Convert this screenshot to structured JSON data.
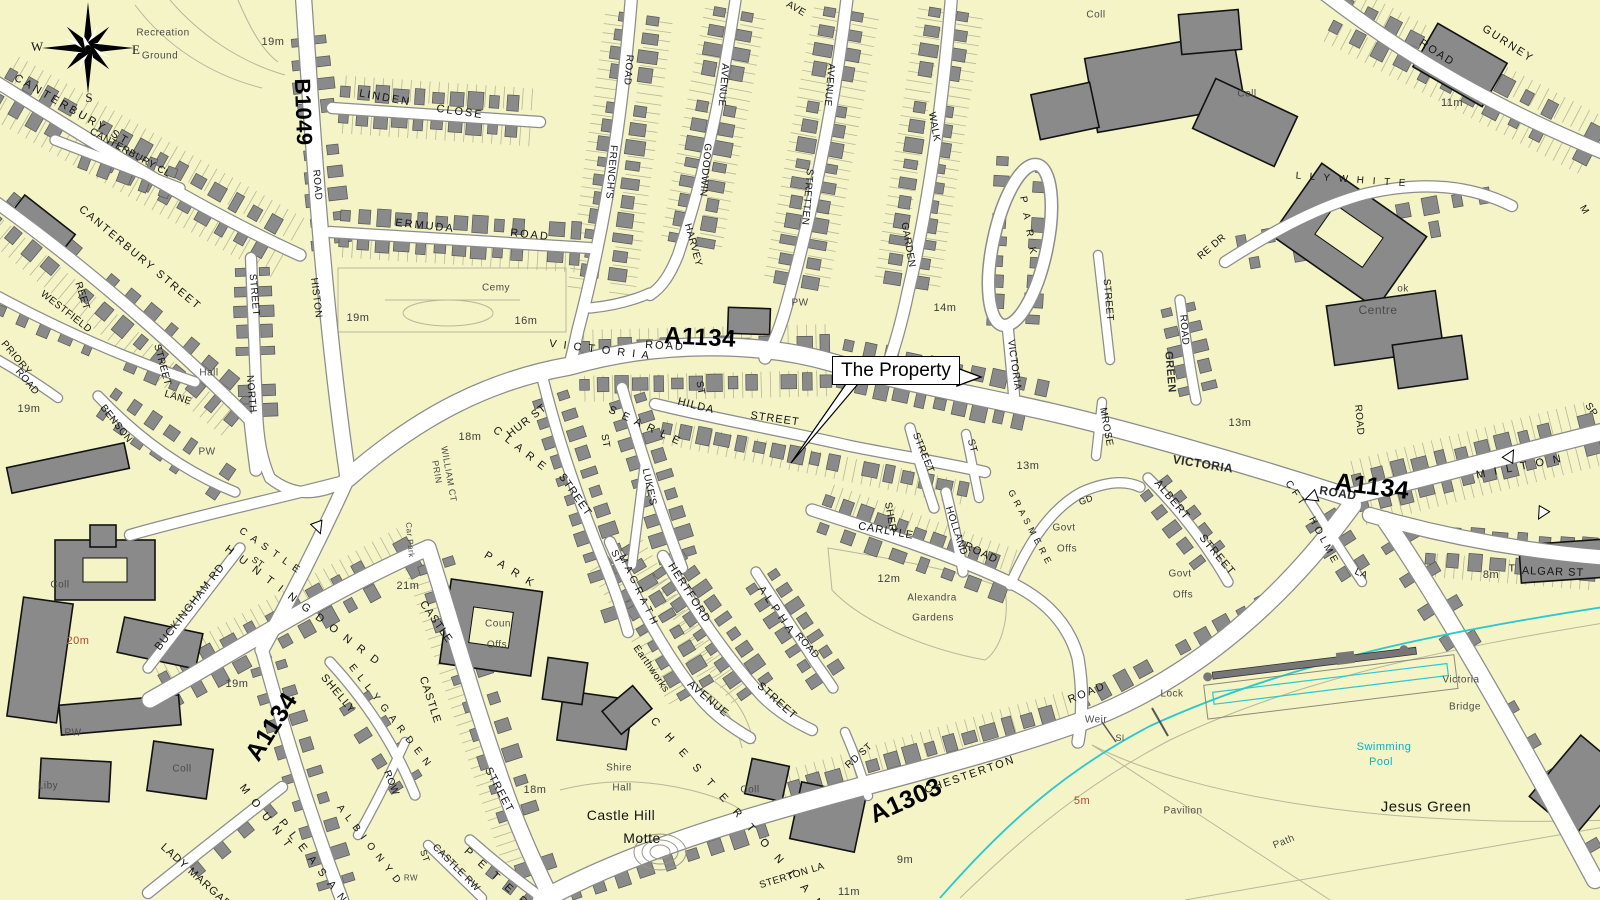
{
  "map": {
    "callout": {
      "text": "The Property"
    },
    "compass": {
      "west": "W",
      "east": "E",
      "south": "S"
    },
    "colors": {
      "land": "#f4f4c6",
      "building": "#8a8a8a",
      "building_outline": "#565656",
      "public_building_outline": "#111111",
      "road_fill": "#ffffff",
      "road_casing": "#8c8c8c",
      "parcel_line": "#b7b79b",
      "water": "#2cc8d0",
      "street_label": "#141414",
      "minor_label": "#4a4a4a",
      "spot_height_red": "#b5472e",
      "route_label": "#000000"
    },
    "labels": [
      {
        "t": "Recreation",
        "x": 163,
        "y": 33,
        "c": "minor"
      },
      {
        "t": "Ground",
        "x": 160,
        "y": 56,
        "c": "minor"
      },
      {
        "t": "19m",
        "x": 273,
        "y": 42,
        "c": "spot"
      },
      {
        "t": "CANTERBURY ST",
        "x": 72,
        "y": 110,
        "r": 30,
        "ls": 3
      },
      {
        "t": "CANTERBURY CL",
        "x": 130,
        "y": 153,
        "r": 29,
        "s": 10
      },
      {
        "t": "CANTERBURY STREET",
        "x": 140,
        "y": 258,
        "r": 40,
        "ls": 2
      },
      {
        "t": "WESTFIELD",
        "x": 66,
        "y": 312,
        "r": 38,
        "s": 10
      },
      {
        "t": "REET",
        "x": 82,
        "y": 296,
        "r": 72,
        "s": 10
      },
      {
        "t": "PRIORY",
        "x": 16,
        "y": 358,
        "r": 50,
        "s": 10
      },
      {
        "t": "ROAD",
        "x": 27,
        "y": 382,
        "r": 50,
        "s": 10
      },
      {
        "t": "19m",
        "x": 29,
        "y": 409,
        "c": "spot"
      },
      {
        "t": "BENSON",
        "x": 116,
        "y": 424,
        "r": 52,
        "s": 10
      },
      {
        "t": "STREET",
        "x": 162,
        "y": 365,
        "r": 75,
        "s": 10
      },
      {
        "t": "LANE",
        "x": 178,
        "y": 398,
        "r": 18,
        "s": 10
      },
      {
        "t": "Hall",
        "x": 209,
        "y": 373,
        "c": "minor"
      },
      {
        "t": "PW",
        "x": 207,
        "y": 452,
        "c": "minor"
      },
      {
        "t": "STREET",
        "x": 254,
        "y": 295,
        "r": 85,
        "s": 10
      },
      {
        "t": "NORTH",
        "x": 251,
        "y": 394,
        "r": 85,
        "s": 10
      },
      {
        "t": "B1049",
        "x": 303,
        "y": 112,
        "r": 88,
        "c": "route",
        "s": 22
      },
      {
        "t": "ROAD",
        "x": 317,
        "y": 185,
        "r": 85,
        "s": 10
      },
      {
        "t": "HISTON",
        "x": 316,
        "y": 298,
        "r": 83,
        "s": 10
      },
      {
        "t": "LINDEN",
        "x": 385,
        "y": 98,
        "r": 10,
        "ls": 2
      },
      {
        "t": "CLOSE",
        "x": 460,
        "y": 112,
        "r": 8,
        "ls": 2
      },
      {
        "t": "ERMUDA",
        "x": 425,
        "y": 226,
        "r": 6,
        "ls": 2
      },
      {
        "t": "ROAD",
        "x": 530,
        "y": 235,
        "r": 6,
        "ls": 2
      },
      {
        "t": "Cemy",
        "x": 496,
        "y": 288,
        "c": "minor"
      },
      {
        "t": "19m",
        "x": 358,
        "y": 318,
        "c": "spot"
      },
      {
        "t": "16m",
        "x": 526,
        "y": 321,
        "c": "spot"
      },
      {
        "t": "ROAD",
        "x": 628,
        "y": 70,
        "r": 95,
        "s": 10
      },
      {
        "t": "FRENCH'S",
        "x": 611,
        "y": 172,
        "r": 95,
        "s": 10
      },
      {
        "t": "AVENUE",
        "x": 723,
        "y": 85,
        "r": 95,
        "s": 10
      },
      {
        "t": "GOODWIN",
        "x": 705,
        "y": 170,
        "r": 95,
        "s": 10
      },
      {
        "t": "HARVEY",
        "x": 693,
        "y": 245,
        "r": 75,
        "s": 10
      },
      {
        "t": "AVE",
        "x": 796,
        "y": 9,
        "r": 30,
        "s": 10
      },
      {
        "t": "AVENUE",
        "x": 829,
        "y": 85,
        "r": 95,
        "s": 10
      },
      {
        "t": "STRETTEN",
        "x": 807,
        "y": 197,
        "r": 95,
        "s": 10
      },
      {
        "t": "WALK",
        "x": 934,
        "y": 127,
        "r": 80,
        "s": 10
      },
      {
        "t": "GARDEN",
        "x": 908,
        "y": 245,
        "r": 80,
        "s": 10
      },
      {
        "t": "PW",
        "x": 800,
        "y": 303,
        "c": "minor"
      },
      {
        "t": "14m",
        "x": 945,
        "y": 308,
        "c": "spot"
      },
      {
        "t": "P A R K",
        "x": 1028,
        "y": 227,
        "r": 80,
        "s": 10,
        "ls": 4
      },
      {
        "t": "VICTORIA",
        "x": 1014,
        "y": 365,
        "r": 82,
        "s": 10
      },
      {
        "t": "STREET",
        "x": 1108,
        "y": 300,
        "r": 85,
        "s": 10
      },
      {
        "t": "Coll",
        "x": 1096,
        "y": 15,
        "c": "minor"
      },
      {
        "t": "Coll",
        "x": 1247,
        "y": 94,
        "c": "minor"
      },
      {
        "t": "ROAD",
        "x": 1437,
        "y": 53,
        "r": 33,
        "ls": 2
      },
      {
        "t": "GURNEY",
        "x": 1508,
        "y": 44,
        "r": 33,
        "ls": 2
      },
      {
        "t": "11m",
        "x": 1452,
        "y": 103,
        "c": "spot"
      },
      {
        "t": "L L Y W H I T E",
        "x": 1352,
        "y": 180,
        "r": 4,
        "s": 10,
        "ls": 3
      },
      {
        "t": "RE DR",
        "x": 1212,
        "y": 247,
        "r": -40,
        "s": 10
      },
      {
        "t": "M",
        "x": 1584,
        "y": 210,
        "r": 60,
        "s": 10
      },
      {
        "t": "ok",
        "x": 1403,
        "y": 289,
        "c": "minor"
      },
      {
        "t": "Centre",
        "x": 1378,
        "y": 310,
        "c": "minor",
        "s": 12
      },
      {
        "t": "GREEN",
        "x": 1170,
        "y": 372,
        "r": 85,
        "c": "routeGrey",
        "s": 11
      },
      {
        "t": "ROAD",
        "x": 1184,
        "y": 330,
        "r": 85,
        "s": 10
      },
      {
        "t": "13m",
        "x": 1240,
        "y": 423,
        "c": "spot"
      },
      {
        "t": "MROSE",
        "x": 1106,
        "y": 427,
        "r": 80,
        "s": 10
      },
      {
        "t": "VICTORIA",
        "x": 1203,
        "y": 464,
        "r": 9,
        "c": "routeGrey",
        "s": 12
      },
      {
        "t": "ROAD",
        "x": 1338,
        "y": 493,
        "r": 9,
        "c": "routeGrey",
        "s": 12
      },
      {
        "t": "A1134",
        "x": 1372,
        "y": 487,
        "r": 7,
        "c": "route",
        "s": 25
      },
      {
        "t": "ROAD",
        "x": 1359,
        "y": 420,
        "r": 85,
        "s": 10
      },
      {
        "t": "M I L T O N",
        "x": 1520,
        "y": 467,
        "r": -11,
        "ls": 3
      },
      {
        "t": "SP",
        "x": 1591,
        "y": 410,
        "r": 55,
        "s": 10
      },
      {
        "t": "C F T",
        "x": 1295,
        "y": 493,
        "r": 55,
        "s": 10
      },
      {
        "t": "H O L M E",
        "x": 1323,
        "y": 540,
        "r": 62,
        "s": 10
      },
      {
        "t": "LA",
        "x": 1361,
        "y": 574,
        "r": 25,
        "s": 10
      },
      {
        "t": "8m",
        "x": 1491,
        "y": 575,
        "c": "spot"
      },
      {
        "t": "T",
        "x": 1512,
        "y": 569,
        "s": 10
      },
      {
        "t": "ALGAR ST",
        "x": 1553,
        "y": 572,
        "r": 2,
        "ls": 1
      },
      {
        "t": "A1134",
        "x": 700,
        "y": 338,
        "r": 3,
        "c": "route",
        "s": 24
      },
      {
        "t": "V I C T O R I A",
        "x": 600,
        "y": 350,
        "r": 7,
        "ls": 2
      },
      {
        "t": "ROAD",
        "x": 665,
        "y": 346,
        "r": 3,
        "ls": 2
      },
      {
        "t": "ST",
        "x": 700,
        "y": 388,
        "r": 80,
        "s": 10
      },
      {
        "t": "HILDA",
        "x": 696,
        "y": 406,
        "r": 14,
        "ls": 1
      },
      {
        "t": "STREET",
        "x": 775,
        "y": 419,
        "r": 8,
        "ls": 1
      },
      {
        "t": "18m",
        "x": 470,
        "y": 437,
        "c": "spot"
      },
      {
        "t": "PRIN",
        "x": 437,
        "y": 472,
        "r": 80,
        "s": 9,
        "c": "minor"
      },
      {
        "t": "WILLIAM CT",
        "x": 449,
        "y": 474,
        "r": 80,
        "s": 9,
        "c": "minor"
      },
      {
        "t": "HUR ST",
        "x": 527,
        "y": 421,
        "r": -38,
        "ls": 1
      },
      {
        "t": "C L A R E",
        "x": 520,
        "y": 449,
        "r": 38,
        "ls": 2
      },
      {
        "t": "STREET",
        "x": 575,
        "y": 495,
        "r": 55,
        "ls": 1
      },
      {
        "t": "S E A R L E",
        "x": 645,
        "y": 426,
        "r": 25,
        "ls": 2
      },
      {
        "t": "ST",
        "x": 605,
        "y": 441,
        "r": 80,
        "s": 10
      },
      {
        "t": "LUKE'S",
        "x": 649,
        "y": 487,
        "r": 78,
        "s": 10
      },
      {
        "t": "STREET",
        "x": 923,
        "y": 453,
        "r": 68,
        "s": 10
      },
      {
        "t": "ST",
        "x": 972,
        "y": 446,
        "r": 75,
        "s": 10
      },
      {
        "t": "SHER",
        "x": 890,
        "y": 517,
        "r": 80,
        "s": 10
      },
      {
        "t": "CARLYLE",
        "x": 886,
        "y": 531,
        "r": 10,
        "ls": 1
      },
      {
        "t": "HOLLAND",
        "x": 956,
        "y": 531,
        "r": 72,
        "s": 10
      },
      {
        "t": "ROAD",
        "x": 981,
        "y": 553,
        "r": 25,
        "ls": 1
      },
      {
        "t": "G R A S M E R E",
        "x": 1030,
        "y": 527,
        "r": 62,
        "s": 9,
        "ls": 1
      },
      {
        "t": "GD",
        "x": 1086,
        "y": 500,
        "r": -20,
        "s": 9
      },
      {
        "t": "Govt",
        "x": 1064,
        "y": 528,
        "c": "minor"
      },
      {
        "t": "Offs",
        "x": 1067,
        "y": 549,
        "c": "minor"
      },
      {
        "t": "Govt",
        "x": 1180,
        "y": 574,
        "c": "minor"
      },
      {
        "t": "Offs",
        "x": 1183,
        "y": 595,
        "c": "minor"
      },
      {
        "t": "ALBERT",
        "x": 1172,
        "y": 500,
        "r": 50,
        "ls": 1
      },
      {
        "t": "STREET",
        "x": 1217,
        "y": 555,
        "r": 50,
        "ls": 1
      },
      {
        "t": "13m",
        "x": 1028,
        "y": 466,
        "c": "spot"
      },
      {
        "t": "12m",
        "x": 889,
        "y": 579,
        "c": "spot"
      },
      {
        "t": "Alexandra",
        "x": 932,
        "y": 598,
        "c": "minor"
      },
      {
        "t": "Gardens",
        "x": 933,
        "y": 618,
        "c": "minor"
      },
      {
        "t": "ST",
        "x": 616,
        "y": 557,
        "r": 65,
        "s": 10
      },
      {
        "t": "M A G R A T H",
        "x": 638,
        "y": 590,
        "r": 64,
        "s": 10,
        "ls": 1
      },
      {
        "t": "AVENUE",
        "x": 708,
        "y": 699,
        "r": 40,
        "ls": 1
      },
      {
        "t": "HERTFORD",
        "x": 689,
        "y": 593,
        "r": 57,
        "ls": 1
      },
      {
        "t": "STREET",
        "x": 777,
        "y": 701,
        "r": 42,
        "ls": 1
      },
      {
        "t": "A L P H A",
        "x": 776,
        "y": 610,
        "r": 55,
        "ls": 1
      },
      {
        "t": "ROAD",
        "x": 807,
        "y": 646,
        "r": 48,
        "s": 10
      },
      {
        "t": "Earthworks",
        "x": 651,
        "y": 669,
        "r": 55,
        "s": 10
      },
      {
        "t": "RD ST",
        "x": 859,
        "y": 756,
        "r": -42,
        "s": 10
      },
      {
        "t": "C H E S T E R T O N  L A N E",
        "x": 745,
        "y": 822,
        "r": 48,
        "ls": 5
      },
      {
        "t": "A1303",
        "x": 906,
        "y": 801,
        "r": -24,
        "c": "route",
        "s": 25
      },
      {
        "t": "STERTON LA",
        "x": 792,
        "y": 876,
        "r": -17,
        "s": 10
      },
      {
        "t": "CHESTERTON",
        "x": 970,
        "y": 775,
        "r": -19,
        "ls": 2
      },
      {
        "t": "ROAD",
        "x": 1087,
        "y": 693,
        "r": -22,
        "ls": 2
      },
      {
        "t": "9m",
        "x": 905,
        "y": 860,
        "c": "spot"
      },
      {
        "t": "11m",
        "x": 849,
        "y": 892,
        "c": "spot"
      },
      {
        "t": "Coll",
        "x": 750,
        "y": 790,
        "c": "minor"
      },
      {
        "t": "Shire",
        "x": 619,
        "y": 768,
        "c": "minor"
      },
      {
        "t": "Hall",
        "x": 622,
        "y": 788,
        "c": "minor"
      },
      {
        "t": "Castle Hill",
        "x": 621,
        "y": 815,
        "s": 14
      },
      {
        "t": "Motte",
        "x": 642,
        "y": 838,
        "s": 14
      },
      {
        "t": "18m",
        "x": 535,
        "y": 790,
        "c": "spot"
      },
      {
        "t": "Car Park",
        "x": 410,
        "y": 540,
        "r": 85,
        "s": 8,
        "c": "minor"
      },
      {
        "t": "21m",
        "x": 408,
        "y": 586,
        "c": "spot"
      },
      {
        "t": "P A R K",
        "x": 510,
        "y": 570,
        "r": 32,
        "ls": 3
      },
      {
        "t": "CASTLE",
        "x": 436,
        "y": 622,
        "r": 55,
        "ls": 1
      },
      {
        "t": "Coun",
        "x": 498,
        "y": 624,
        "c": "minor"
      },
      {
        "t": "Offs",
        "x": 497,
        "y": 645,
        "c": "minor"
      },
      {
        "t": "CASTLE",
        "x": 430,
        "y": 700,
        "r": 72,
        "ls": 1
      },
      {
        "t": "STREET",
        "x": 499,
        "y": 790,
        "r": 62,
        "ls": 1
      },
      {
        "t": "C A S T L E",
        "x": 270,
        "y": 551,
        "r": 35,
        "s": 10,
        "ls": 2
      },
      {
        "t": "ST",
        "x": 258,
        "y": 562,
        "r": 35,
        "s": 9
      },
      {
        "t": "H U N T I N G D O N  R D",
        "x": 303,
        "y": 606,
        "r": 37,
        "ls": 3
      },
      {
        "t": "BUCKINGHAM RD",
        "x": 190,
        "y": 607,
        "r": -52,
        "ls": 1
      },
      {
        "t": "20m",
        "x": 78,
        "y": 641,
        "c": "spotRed"
      },
      {
        "t": "Coll",
        "x": 60,
        "y": 585,
        "c": "minor"
      },
      {
        "t": "19m",
        "x": 237,
        "y": 684,
        "c": "spot"
      },
      {
        "t": "A1134",
        "x": 272,
        "y": 727,
        "r": -58,
        "c": "route",
        "s": 25
      },
      {
        "t": "SHELLY",
        "x": 338,
        "y": 694,
        "r": 50,
        "ls": 1
      },
      {
        "t": "E L L Y  G A R D E N",
        "x": 390,
        "y": 716,
        "r": 52,
        "s": 10,
        "ls": 2
      },
      {
        "t": "ROW",
        "x": 391,
        "y": 783,
        "r": 68,
        "s": 10
      },
      {
        "t": "A L B I O N  Y D",
        "x": 369,
        "y": 845,
        "r": 52,
        "s": 10,
        "ls": 2
      },
      {
        "t": "ST",
        "x": 425,
        "y": 856,
        "r": 70,
        "s": 9
      },
      {
        "t": "RW",
        "x": 411,
        "y": 878,
        "s": 8,
        "c": "minor"
      },
      {
        "t": "CASTLE RW",
        "x": 456,
        "y": 868,
        "r": 45,
        "s": 10
      },
      {
        "t": "P E T E R",
        "x": 497,
        "y": 878,
        "r": 42,
        "ls": 4
      },
      {
        "t": "M O U N T",
        "x": 266,
        "y": 817,
        "r": 52,
        "ls": 3
      },
      {
        "t": "P L E A S A N T",
        "x": 318,
        "y": 868,
        "r": 52,
        "ls": 3
      },
      {
        "t": "LADY MARGAR",
        "x": 196,
        "y": 876,
        "r": 42,
        "ls": 1
      },
      {
        "t": "PW",
        "x": 73,
        "y": 733,
        "c": "minor"
      },
      {
        "t": "Liby",
        "x": 48,
        "y": 786,
        "c": "minor"
      },
      {
        "t": "Coll",
        "x": 182,
        "y": 769,
        "c": "minor"
      },
      {
        "t": "Lock",
        "x": 1172,
        "y": 694,
        "c": "minor"
      },
      {
        "t": "Weir",
        "x": 1096,
        "y": 720,
        "c": "minor"
      },
      {
        "t": "Sl",
        "x": 1120,
        "y": 738,
        "c": "minor",
        "s": 9
      },
      {
        "t": "5m",
        "x": 1082,
        "y": 801,
        "c": "spotRed"
      },
      {
        "t": "Pavilion",
        "x": 1183,
        "y": 811,
        "c": "minor"
      },
      {
        "t": "Path",
        "x": 1284,
        "y": 842,
        "r": -22,
        "c": "minor"
      },
      {
        "t": "Swimming",
        "x": 1384,
        "y": 747,
        "c": "water"
      },
      {
        "t": "Pool",
        "x": 1381,
        "y": 762,
        "c": "water"
      },
      {
        "t": "Jesus Green",
        "x": 1426,
        "y": 807,
        "s": 15
      },
      {
        "t": "Victoria",
        "x": 1461,
        "y": 680,
        "c": "minor"
      },
      {
        "t": "Bridge",
        "x": 1465,
        "y": 707,
        "c": "minor"
      }
    ]
  }
}
